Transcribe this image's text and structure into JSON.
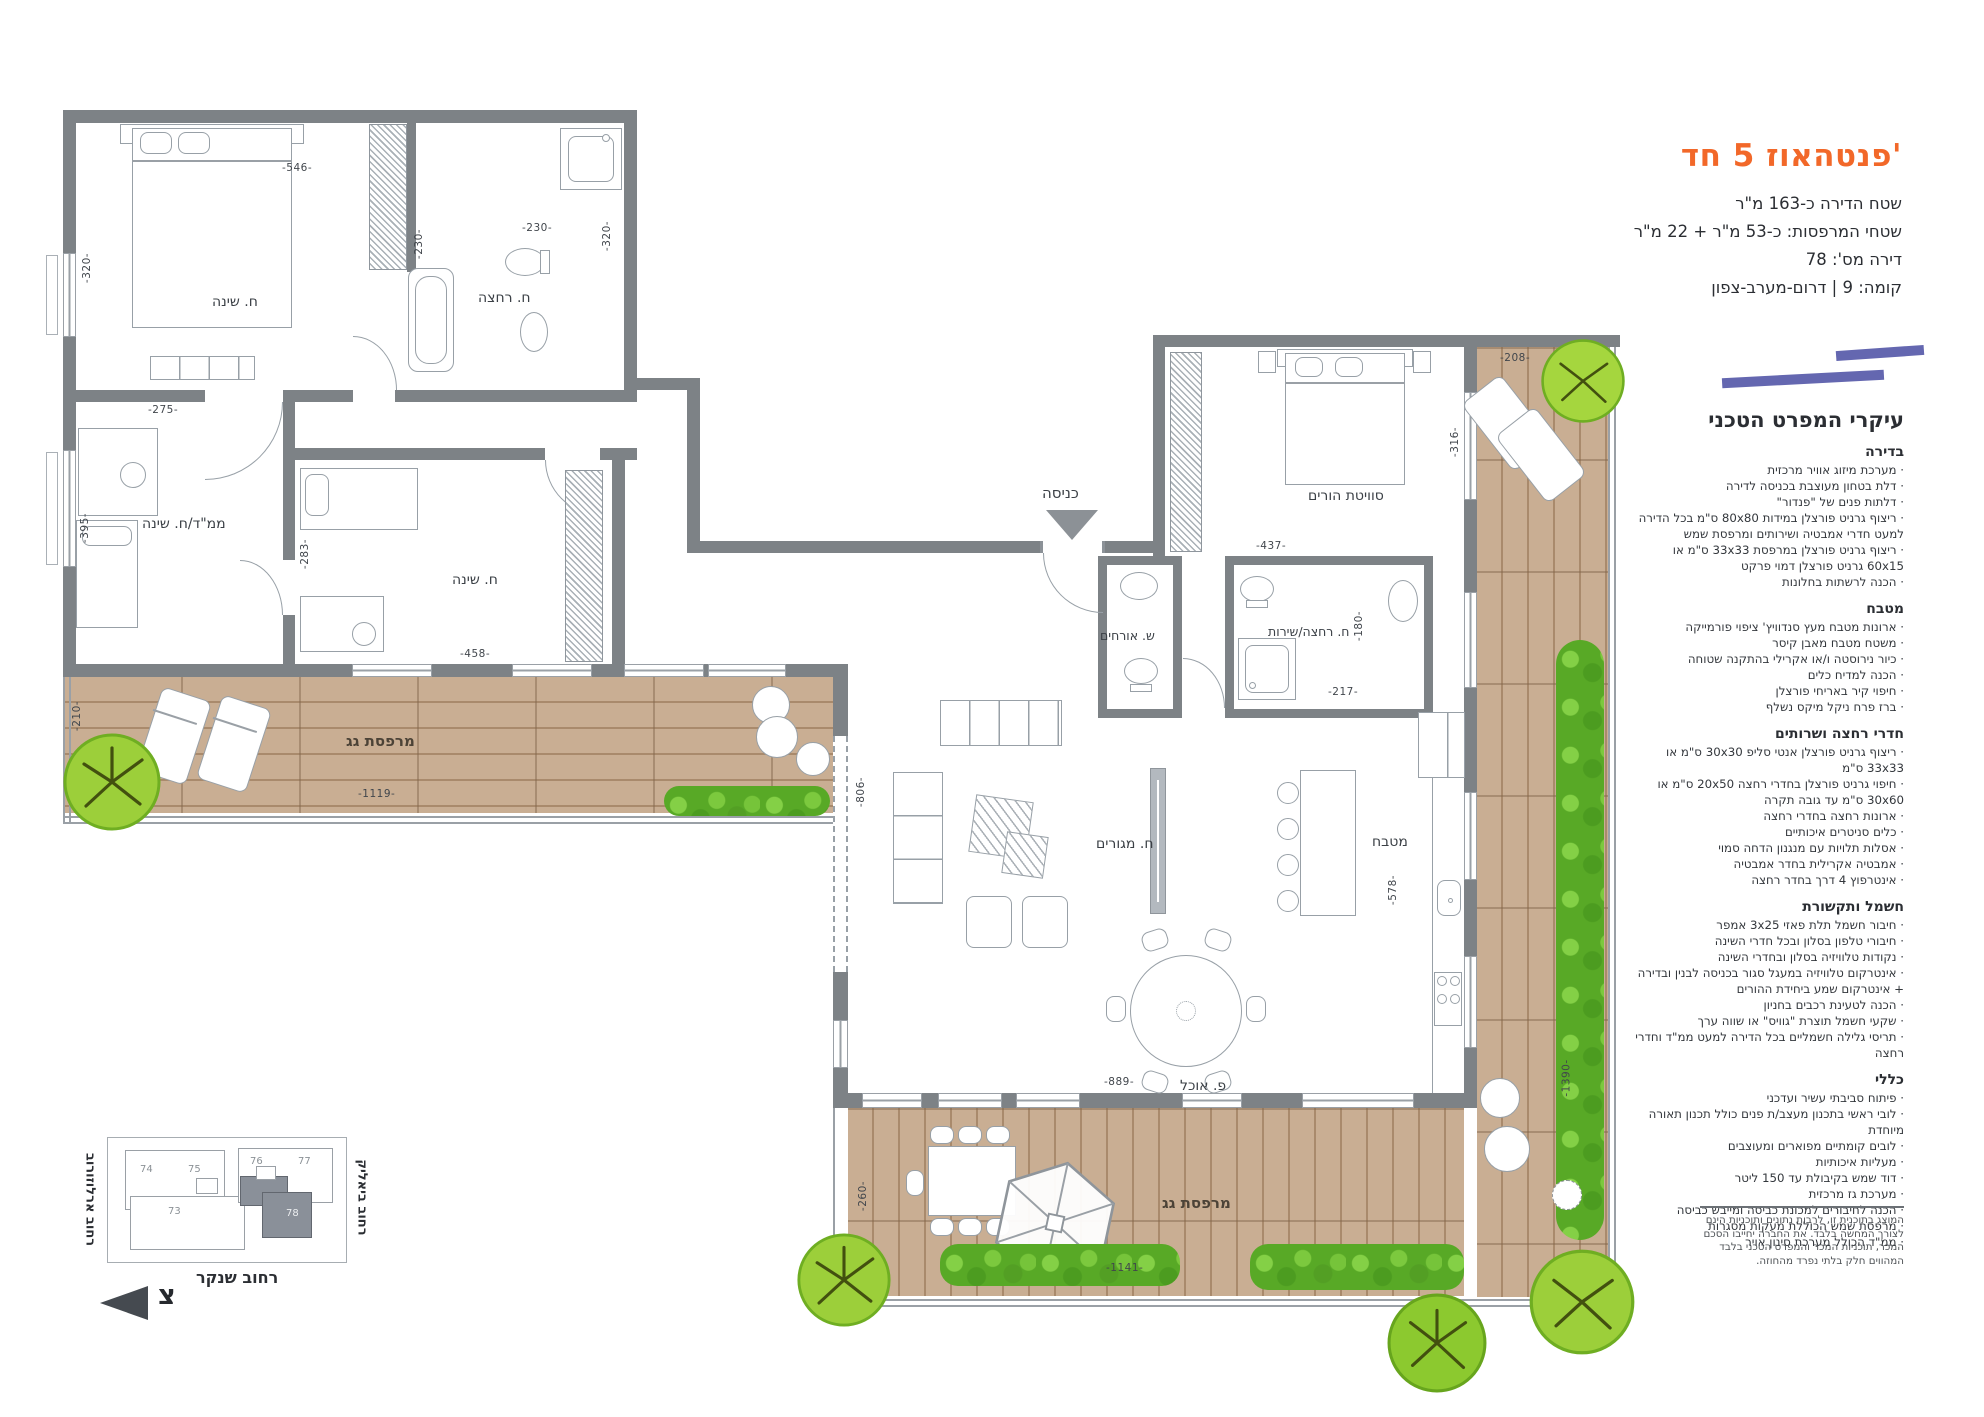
{
  "header": {
    "title": "פנטהאוז 5 חד'",
    "info_lines": [
      "שטח הדירה כ-163 מ\"ר",
      "שטחי המרפסות: כ-53 מ\"ר + 22 מ\"ר",
      "דירה מס': 78",
      "קומה: 9 | דרום-מערב-צפון"
    ]
  },
  "spec": {
    "title": "עיקרי המפרט הטכני",
    "sections": [
      {
        "heading": "בדירה",
        "items": [
          "מערכת מיזוג אוויר מרכזית",
          "דלת בטחון מעוצבת בכניסה לדירה",
          "דלתות פנים של \"פנדור\"",
          "ריצוף גרניט פורצלן במידות 80x80 ס\"מ בכל הדירה למעט חדרי אמבטיה ושירותים ומרפסת שמש",
          "ריצוף גרניט פורצלן במרפסת 33x33 ס\"מ או 60x15 גרניט פורצלן דמוי פרקט",
          "הכנה לרשתות בחלונות"
        ]
      },
      {
        "heading": "מטבח",
        "items": [
          "ארונות מטבח מעץ סנדוויץ' ציפוי פורמייקה",
          "משטח מטבח מאבן קיסר",
          "כיור נירוסטה ו/או אקרילי בהתקנה שטוחה",
          "הכנה למדיח כלים",
          "חיפוי קיר באריחי פורצלן",
          "ברז פרח ניקל מיקס נשלף"
        ]
      },
      {
        "heading": "חדרי רחצה ושרותים",
        "items": [
          "ריצוף גרניט פורצלן אנטי סליפ 30x30 ס\"מ או 33x33 ס\"מ",
          "חיפוי גרניט פורצלן בחדרי רחצה 20x50 ס\"מ או 30x60 ס\"מ עד גובה תקרה",
          "ארונות רחצה בחדרי רחצה",
          "כלים סניטרים איכותיים",
          "אסלות תלויות עם מנגנון הדחה סמוי",
          "אמבטיה אקרילית בחדר אמבטיה",
          "אינטרפוץ 4 דרך בחדר רחצה"
        ]
      },
      {
        "heading": "חשמל ותקשורת",
        "items": [
          "חיבור חשמל תלת פאזי 3x25 אמפר",
          "חיבורי טלפון בסלון ובכל חדרי השינה",
          "נקודות טלוויזיה בסלון ובחדרי השינה",
          "אינטרקום טלוויזיה במעגל סגור בכניסה לבנין ובדירה + אינטרקום שמע ביחידת ההורים",
          "הכנה לטעינת רכבים בחניון",
          "שקעי חשמל תוצרת \"גוויס\" או שווה ערך",
          "תריסי גלילה חשמליים בכל הדירה למעט ממ\"ד וחדרי רחצה"
        ]
      },
      {
        "heading": "כללי",
        "items": [
          "פיתוח סביבתי עשיר ועדכני",
          "לובי ראשי בתכנון מעצב/ת פנים כולל תכנון תאורה מיוחדת",
          "לובים קומתיים מפוארים ומעוצבים",
          "מעליות איכותיות",
          "דוד שמש בקיבולת עד 150 ליטר",
          "מערכת גז מרכזית",
          "הכנה לחיבורים למכונת כביסה ומייבש כביסה",
          "מרפסת שמש הכוללת מעקות מסגרות",
          "ממ\"ד הכולל מערכת סינון אויר"
        ]
      }
    ],
    "disclaimer": "המוצג בתוכנית זו, לרבות נתונים ותוכניות הינם לצורך המחשה בלבד. את החברה יחייבו הסכם המכר, תוכניות המכר והמפרט הטכני בלבד המהווים חלק בלתי נפרד מהחוזה."
  },
  "plan": {
    "rooms": {
      "master": "ח. שינה",
      "mamad": "ממ\"ד/ח. שינה",
      "bedroom2": "ח. שינה",
      "bath1": "ח. רחצה",
      "suite": "סוויטת הורים",
      "guest_wc": "ש. אורחים",
      "bath2": "ח. רחצה/שירות",
      "living": "ח. מגורים",
      "kitchen": "מטבח",
      "dining": "פ. אוכל",
      "terrace_left": "מרפסת גג",
      "terrace_bottom": "מרפסת גג",
      "entrance": "כניסה"
    },
    "dims": {
      "d546": "-546-",
      "d320a": "-320-",
      "d230a": "-230-",
      "d230b": "-230-",
      "d320b": "-320-",
      "d275": "-275-",
      "d395": "-395-",
      "d283": "-283-",
      "d458": "-458-",
      "d210": "-210-",
      "d1119": "-1119-",
      "d806": "-806-",
      "d208": "-208-",
      "d316": "-316-",
      "d437": "-437-",
      "d180": "-180-",
      "d217": "-217-",
      "d578": "-578-",
      "d889": "-889-",
      "d260": "-260-",
      "d1141": "-1141-",
      "d1390": "-1390-"
    }
  },
  "keyplan": {
    "streets": {
      "left": "רחוב ארלוזורוב",
      "right": "רחוב ביאליק",
      "bottom": "רחוב שנקר"
    },
    "north_letter": "צ",
    "units": {
      "u73": "73",
      "u74": "74",
      "u75": "75",
      "u76": "76",
      "u77": "77",
      "u78": "78"
    }
  },
  "colors": {
    "accent_orange": "#f26829",
    "accent_purple": "#6467b0",
    "wall_gray": "#7d8286",
    "deck_tan": "#c9ae93",
    "plant_green": "#7ac03a"
  }
}
